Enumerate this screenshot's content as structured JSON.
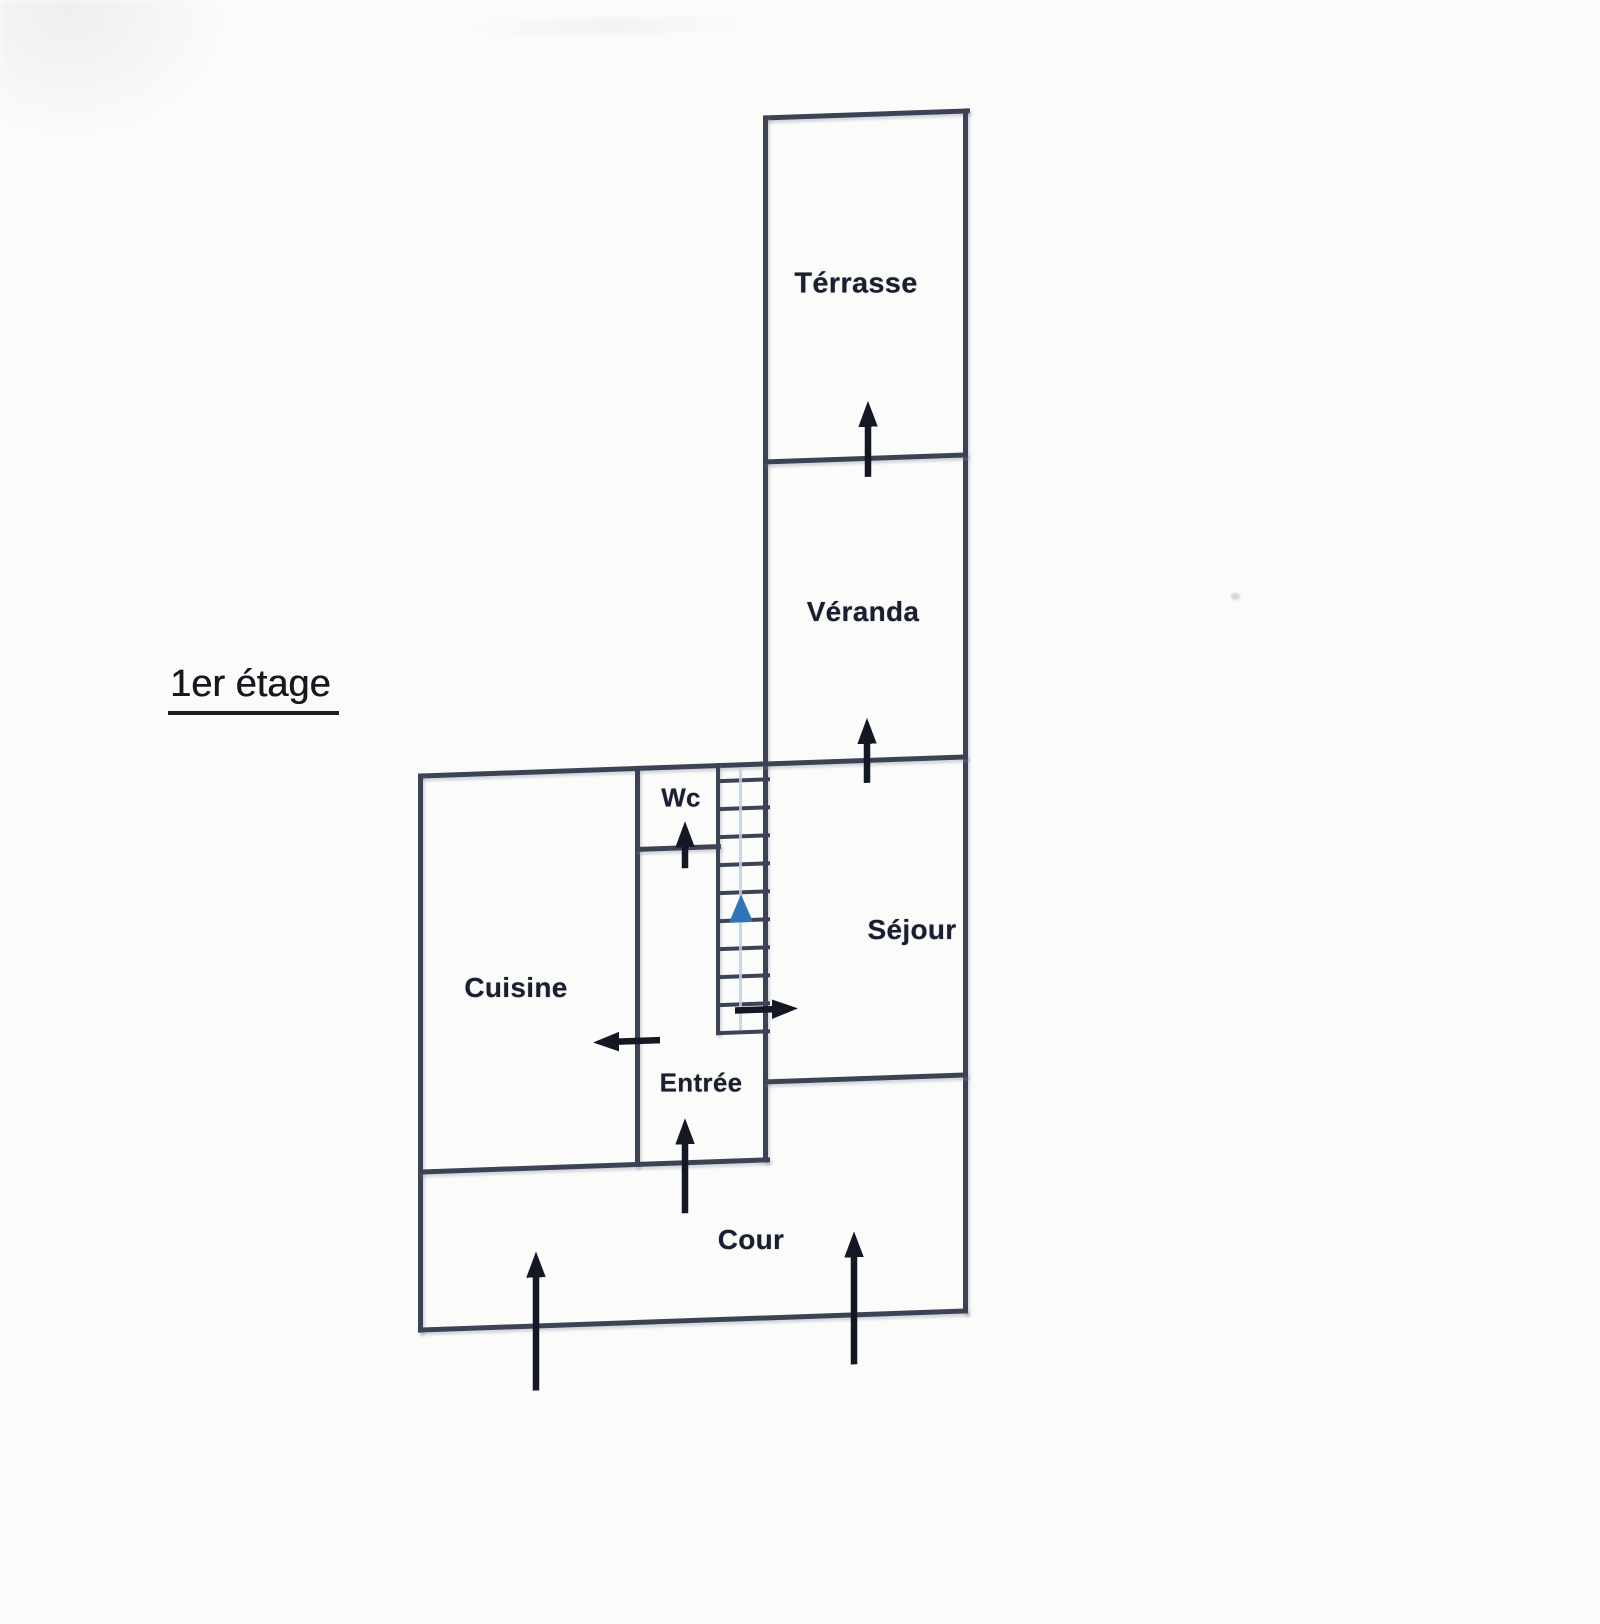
{
  "floor_label": {
    "text": "1er étage"
  },
  "rooms": {
    "terrasse": {
      "label": "Térrasse"
    },
    "veranda": {
      "label": "Véranda"
    },
    "wc": {
      "label": "Wc"
    },
    "sejour": {
      "label": "Séjour"
    },
    "cuisine": {
      "label": "Cuisine"
    },
    "entree": {
      "label": "Entrée"
    },
    "cour": {
      "label": "Cour"
    }
  },
  "stairs": {
    "steps": 10,
    "direction": "up",
    "arrow_color": "#2e75b6"
  },
  "entry_arrows": [
    {
      "name": "terrasse-entry-arrow",
      "room": "Térrasse",
      "direction": "up"
    },
    {
      "name": "veranda-entry-arrow",
      "room": "Véranda",
      "direction": "up"
    },
    {
      "name": "wc-entry-arrow",
      "room": "Wc",
      "direction": "up"
    },
    {
      "name": "sejour-entry-arrow",
      "room": "Séjour",
      "direction": "right"
    },
    {
      "name": "cuisine-entry-arrow",
      "room": "Cuisine",
      "direction": "left"
    },
    {
      "name": "entree-entry-arrow",
      "room": "Entrée",
      "direction": "up"
    },
    {
      "name": "cour-entry-arrow-left",
      "room": "Cour",
      "direction": "up"
    },
    {
      "name": "cour-entry-arrow-right",
      "room": "Cour",
      "direction": "up"
    }
  ],
  "colors": {
    "wall": "#3c4354",
    "label": "#191f30",
    "arrow": "#141824",
    "stair_arrow": "#2e75b6",
    "stair_guide": "#b9d2ec",
    "paper": "#fbfbfa"
  }
}
